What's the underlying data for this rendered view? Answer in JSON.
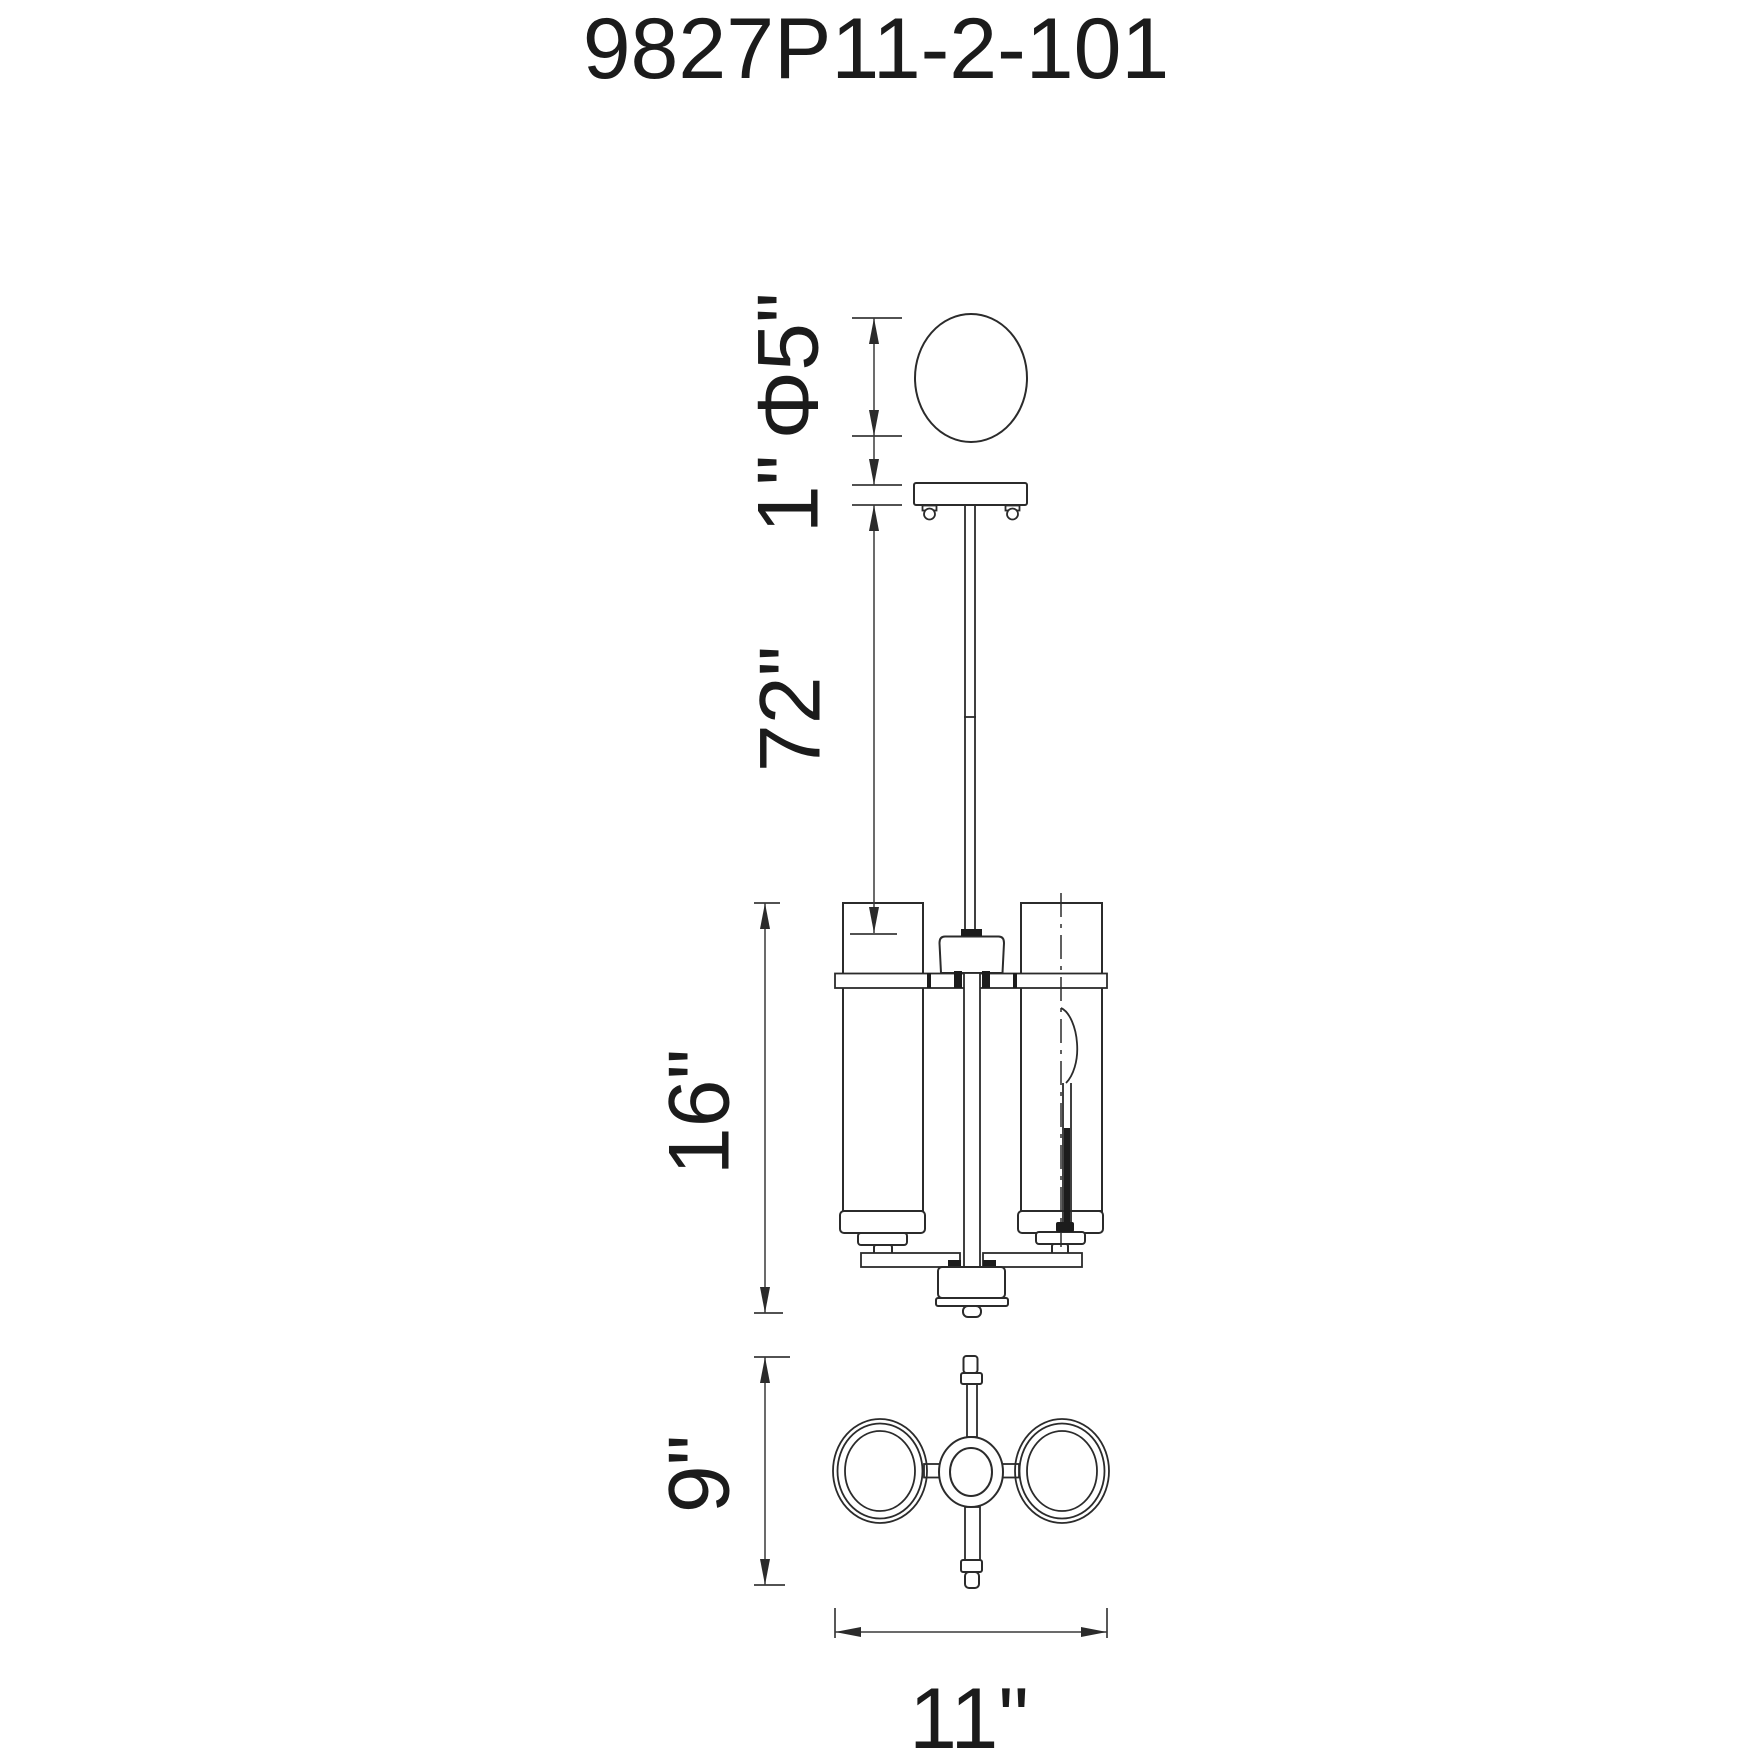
{
  "title": "9827P11-2-101",
  "drawing_type": "pendant light fixture dimension drawing",
  "dimensions": {
    "canopy_diameter": "Φ5\"",
    "canopy_height": "1\"",
    "rod_drop": "72\"",
    "fixture_height": "16\"",
    "fixture_depth": "9\"",
    "fixture_width": "11\""
  },
  "colors": {
    "line": "#2b2b2b",
    "dimension_line": "#3a3a3a",
    "text": "#1b1b1b",
    "background": "#ffffff"
  }
}
